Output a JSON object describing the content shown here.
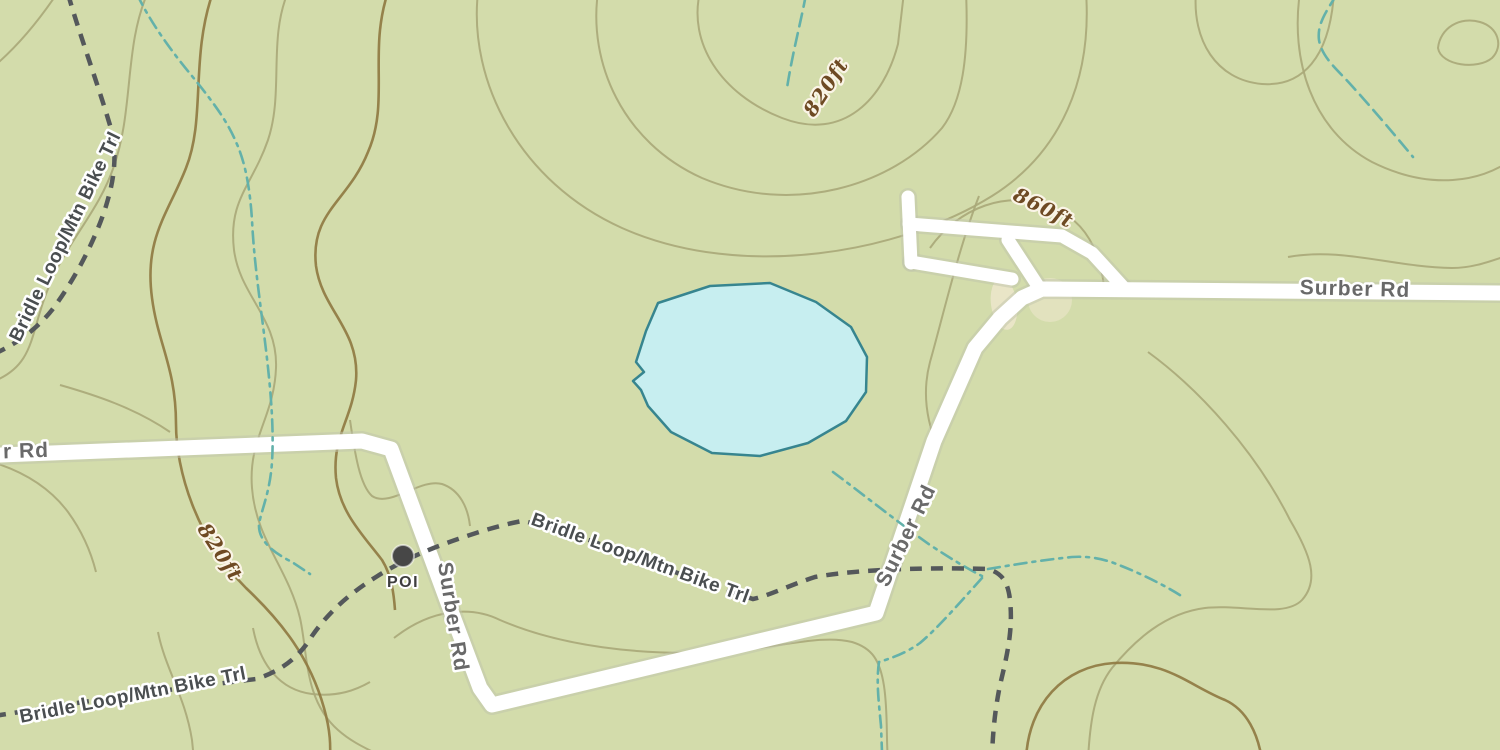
{
  "map": {
    "kind": "topographic-map",
    "palette": {
      "background": "#d3dcab",
      "contour": "#a9a878",
      "contour_index": "#8f7a42",
      "stream": "#63b1aa",
      "trail": "#54585b",
      "road_fill": "#ffffff",
      "road_casing": "#bfc4ab",
      "road_label": "#696969",
      "trail_label": "#4a4e50",
      "elevation_label": "#6e4a23",
      "poi_color": "#474747",
      "water_fill": "#c7eef0",
      "water_stroke": "#37858f",
      "clearing": "#ece6cb",
      "halo": "#ffffff",
      "halo_warm": "#faf4e6"
    },
    "clearings": [
      {
        "cx": 1004,
        "cy": 304,
        "rx": 13,
        "ry": 26,
        "rot": -8,
        "opacity": 0.85
      },
      {
        "cx": 1050,
        "cy": 300,
        "rx": 22,
        "ry": 22,
        "rot": 0,
        "opacity": 0.6
      }
    ],
    "contours": [
      {
        "d": "M 58,-8 C 38,22 16,48 -8,68",
        "index": false
      },
      {
        "d": "M 148,-8 C 124,46 134,108 114,166 C 98,214 64,244 46,294 C 30,336 34,366 -8,382",
        "index": false
      },
      {
        "d": "M 288,-8 C 268,40 284,92 268,140 C 252,186 228,200 234,250 C 240,296 278,318 276,368 C 274,418 248,438 252,488 C 256,540 288,568 300,618 C 308,654 304,700 338,730 C 356,746 376,752 388,760",
        "index": false
      },
      {
        "d": "M 700,-8 C 688,42 720,94 782,118 C 844,142 884,98 898,44 L 904,-8",
        "index": false
      },
      {
        "d": "M 598,-8 C 588,62 622,142 702,178 C 792,216 892,186 942,128 C 962,102 969,58 966,-8",
        "index": false
      },
      {
        "d": "M 478,-8 C 468,82 520,182 622,228 C 744,282 902,252 992,196 C 1062,152 1092,78 1086,-8",
        "index": false
      },
      {
        "d": "M 1196,-8 C 1192,40 1216,80 1262,84 C 1302,87 1330,58 1334,-8",
        "index": false
      },
      {
        "d": "M 1288,257 C 1342,247 1392,267 1452,268 C 1472,268 1488,262 1506,256",
        "index": false
      },
      {
        "d": "M 1300,-8 C 1290,60 1312,130 1372,162 C 1432,192 1482,180 1508,162",
        "index": false
      },
      {
        "d": "M 1438,48 C 1440,28 1460,16 1480,22 C 1498,27 1504,46 1492,58 C 1478,70 1441,66 1438,48 Z",
        "index": false
      },
      {
        "d": "M 1148,352 C 1200,390 1256,452 1290,520 C 1310,554 1320,580 1302,600 C 1285,618 1240,604 1205,608 C 1165,613 1135,640 1112,668 C 1095,690 1090,720 1088,760",
        "index": false
      },
      {
        "d": "M 979,196 C 958,250 942,320 930,362 C 922,392 926,420 938,448",
        "index": false
      },
      {
        "d": "M 930,248 C 958,208 1008,188 1054,208 C 1086,222 1100,252 1104,286",
        "index": false
      },
      {
        "d": "M 158,632 C 165,668 185,696 192,740 L 194,760",
        "index": false
      },
      {
        "d": "M 253,628 C 260,665 280,690 312,694 C 338,697 356,690 370,682",
        "index": false
      },
      {
        "d": "M 394,638 C 432,608 472,606 500,620 C 560,646 640,656 720,652 C 780,648 820,634 852,642 C 872,648 880,660 884,686 C 888,712 886,740 888,760",
        "index": false
      },
      {
        "d": "M 350,420 C 355,455 360,485 372,496 C 390,508 420,478 442,484 C 460,490 468,508 470,526",
        "index": false
      },
      {
        "d": "M 60,385 C 95,395 135,408 170,432",
        "index": false
      },
      {
        "d": "M -8,462 C 25,472 50,488 68,512 C 84,534 92,556 96,572",
        "index": false
      },
      {
        "d": "M 213,-8 C 190,58 206,118 186,168 C 168,214 144,238 152,298 C 158,344 176,368 176,424 C 176,470 196,538 246,588 C 282,622 310,658 324,708 C 332,736 330,752 330,760",
        "index": true
      },
      {
        "d": "M 388,-8 C 368,52 390,102 368,152 C 348,202 310,212 316,266 C 322,310 360,330 356,380 C 352,420 332,436 336,478 C 340,512 362,534 382,560 C 392,576 394,596 395,610",
        "index": true
      },
      {
        "d": "M 1026,760 C 1028,704 1064,666 1114,663 C 1166,660 1190,686 1225,700 C 1247,710 1258,734 1262,760",
        "index": true
      }
    ],
    "pond": {
      "name": "pond",
      "points": "658,303 710,286 770,283 816,302 851,327 867,357 866,392 846,421 808,443 760,456 712,453 671,432 648,406 641,390 633,381 644,372 636,362 646,331"
    },
    "roads": [
      {
        "name": "surber-rd-main",
        "width": 15,
        "d": "M 0,455 L 362,441 L 391,449 L 448,603 L 480,688 L 492,705 L 876,613 L 934,441 L 975,348 L 1000,318 L 1022,298 L 1042,289 L 1500,293"
      },
      {
        "name": "road-spur-stub",
        "width": 13,
        "d": "M 908,197 L 911,263"
      },
      {
        "name": "road-spur-upper",
        "width": 13,
        "d": "M 909,224 L 1062,236 L 1092,253 L 1124,288"
      },
      {
        "name": "road-spur-lower",
        "width": 13,
        "d": "M 911,262 L 1012,279"
      },
      {
        "name": "road-spur-diagonal",
        "width": 13,
        "d": "M 1008,240 L 1038,286"
      }
    ],
    "streams": [
      {
        "style": "dashdot",
        "d": "M 137,-6 C 150,22 172,52 192,76 C 208,96 226,118 236,142 C 246,164 250,190 252,220 C 254,262 260,300 266,350 C 271,392 274,430 272,462 C 270,492 262,508 259,524 C 258,540 272,552 292,562 L 310,574"
      },
      {
        "style": "dash",
        "d": "M 806,-6 C 801,22 793,50 787,88"
      },
      {
        "style": "dash",
        "d": "M 1337,-6 C 1326,12 1317,24 1319,40 C 1322,58 1338,70 1352,86 C 1372,108 1394,134 1413,157"
      },
      {
        "style": "dashdot",
        "d": "M 988,569 C 1012,565 1042,560 1072,557 C 1087,556 1102,558 1119,565 C 1142,574 1166,586 1183,597"
      },
      {
        "style": "dashdot",
        "d": "M 833,472 C 860,492 895,520 930,545 C 950,558 966,568 982,576"
      },
      {
        "style": "dashdot",
        "d": "M 982,578 C 962,600 940,626 920,643 C 906,653 892,658 879,662 C 876,682 879,704 881,726 L 882,752"
      }
    ],
    "trails": [
      {
        "name": "bridle-loop-mtn-bike-trl-north",
        "d": "M 68,-6 C 80,36 98,84 112,132 C 117,158 114,180 106,206 C 96,238 76,278 52,310 C 36,330 16,344 -6,354"
      },
      {
        "name": "bridle-loop-mtn-bike-trl-main",
        "d": "M -6,716 L 70,704 L 160,691 L 256,679 C 282,671 300,656 312,636 C 330,610 352,592 376,577 C 404,559 436,546 470,535 C 488,529 506,524 522,521 C 560,528 600,544 648,562 C 688,577 724,590 753,599 C 768,596 790,585 815,577 C 855,570 915,567 988,569 C 1002,573 1008,582 1010,600 C 1013,628 1008,652 1000,685 C 995,710 993,730 992,756"
      }
    ],
    "poi_marker": {
      "x": 403,
      "y": 556,
      "r": 11
    },
    "labels": [
      {
        "id": "road-label-surber-rd-east",
        "type": "road",
        "text": "Surber Rd",
        "x": 1355,
        "y": 290,
        "rot": 1.5
      },
      {
        "id": "road-label-surber-rd-west-partial",
        "type": "road",
        "text": "r Rd",
        "x": 26,
        "y": 452,
        "rot": -2
      },
      {
        "id": "road-label-surber-rd-south",
        "type": "road",
        "text": "Surber Rd",
        "x": 452,
        "y": 617,
        "rot": 81
      },
      {
        "id": "road-label-surber-rd-mid",
        "type": "road",
        "text": "Surber Rd",
        "x": 907,
        "y": 536,
        "rot": -64
      },
      {
        "id": "trail-label-northwest",
        "type": "trail",
        "text": "Bridle Loop/Mtn Bike Trl",
        "x": 66,
        "y": 237,
        "rot": -64
      },
      {
        "id": "trail-label-southwest",
        "type": "trail",
        "text": "Bridle Loop/Mtn Bike Trl",
        "x": 133,
        "y": 696,
        "rot": -11
      },
      {
        "id": "trail-label-center",
        "type": "trail",
        "text": "Bridle Loop/Mtn Bike Trl",
        "x": 640,
        "y": 559,
        "rot": 20
      },
      {
        "id": "elevation-label-820-north",
        "type": "elev",
        "text": "820ft",
        "x": 827,
        "y": 88,
        "rot": -57
      },
      {
        "id": "elevation-label-860",
        "type": "elev",
        "text": "860ft",
        "x": 1043,
        "y": 209,
        "rot": 27
      },
      {
        "id": "elevation-label-820-west",
        "type": "elev",
        "text": "820ft",
        "x": 219,
        "y": 553,
        "rot": 57
      },
      {
        "id": "poi-label",
        "type": "poi",
        "text": "POI",
        "x": 403,
        "y": 583,
        "rot": 0
      }
    ]
  }
}
